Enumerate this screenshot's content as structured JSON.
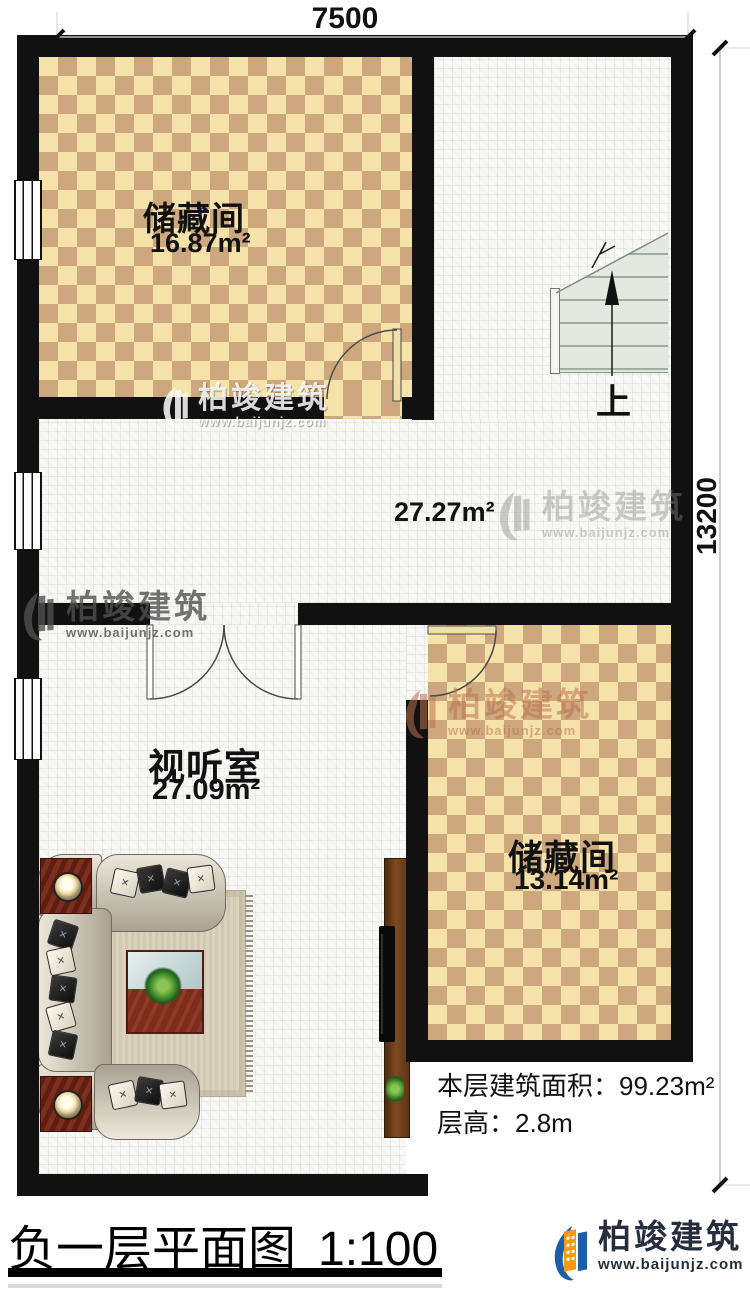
{
  "colors": {
    "wall": "#111111",
    "checker_light": "#f5e2a9",
    "checker_dark": "#cda77d",
    "floor_grid": "#e5e5e3",
    "stair_fill": "#e4e9df",
    "brand_blue": "#1b5fa9",
    "brand_orange": "#f59a0e",
    "brand_text": "#272d3c"
  },
  "dimensions": {
    "top_width": "7500",
    "right_height": "13200"
  },
  "rooms": {
    "storage_top": {
      "name": "储藏间",
      "area": "16.87m²"
    },
    "hall": {
      "area": "27.27m²"
    },
    "av_room": {
      "name": "视听室",
      "area": "27.09m²"
    },
    "storage_right": {
      "name": "储藏间",
      "area": "13.14m²"
    }
  },
  "stairs": {
    "up_label": "上"
  },
  "info": {
    "area_label": "本层建筑面积：",
    "area_value": "99.23m²",
    "height_label": "层高：",
    "height_value": "2.8m"
  },
  "title": {
    "name": "负一层平面图",
    "scale": "1:100"
  },
  "branding": {
    "company": "柏竣建筑",
    "website": "www.baijunjz.com"
  },
  "watermark": {
    "company": "柏竣建筑",
    "website": "www.baijunjz.com"
  }
}
